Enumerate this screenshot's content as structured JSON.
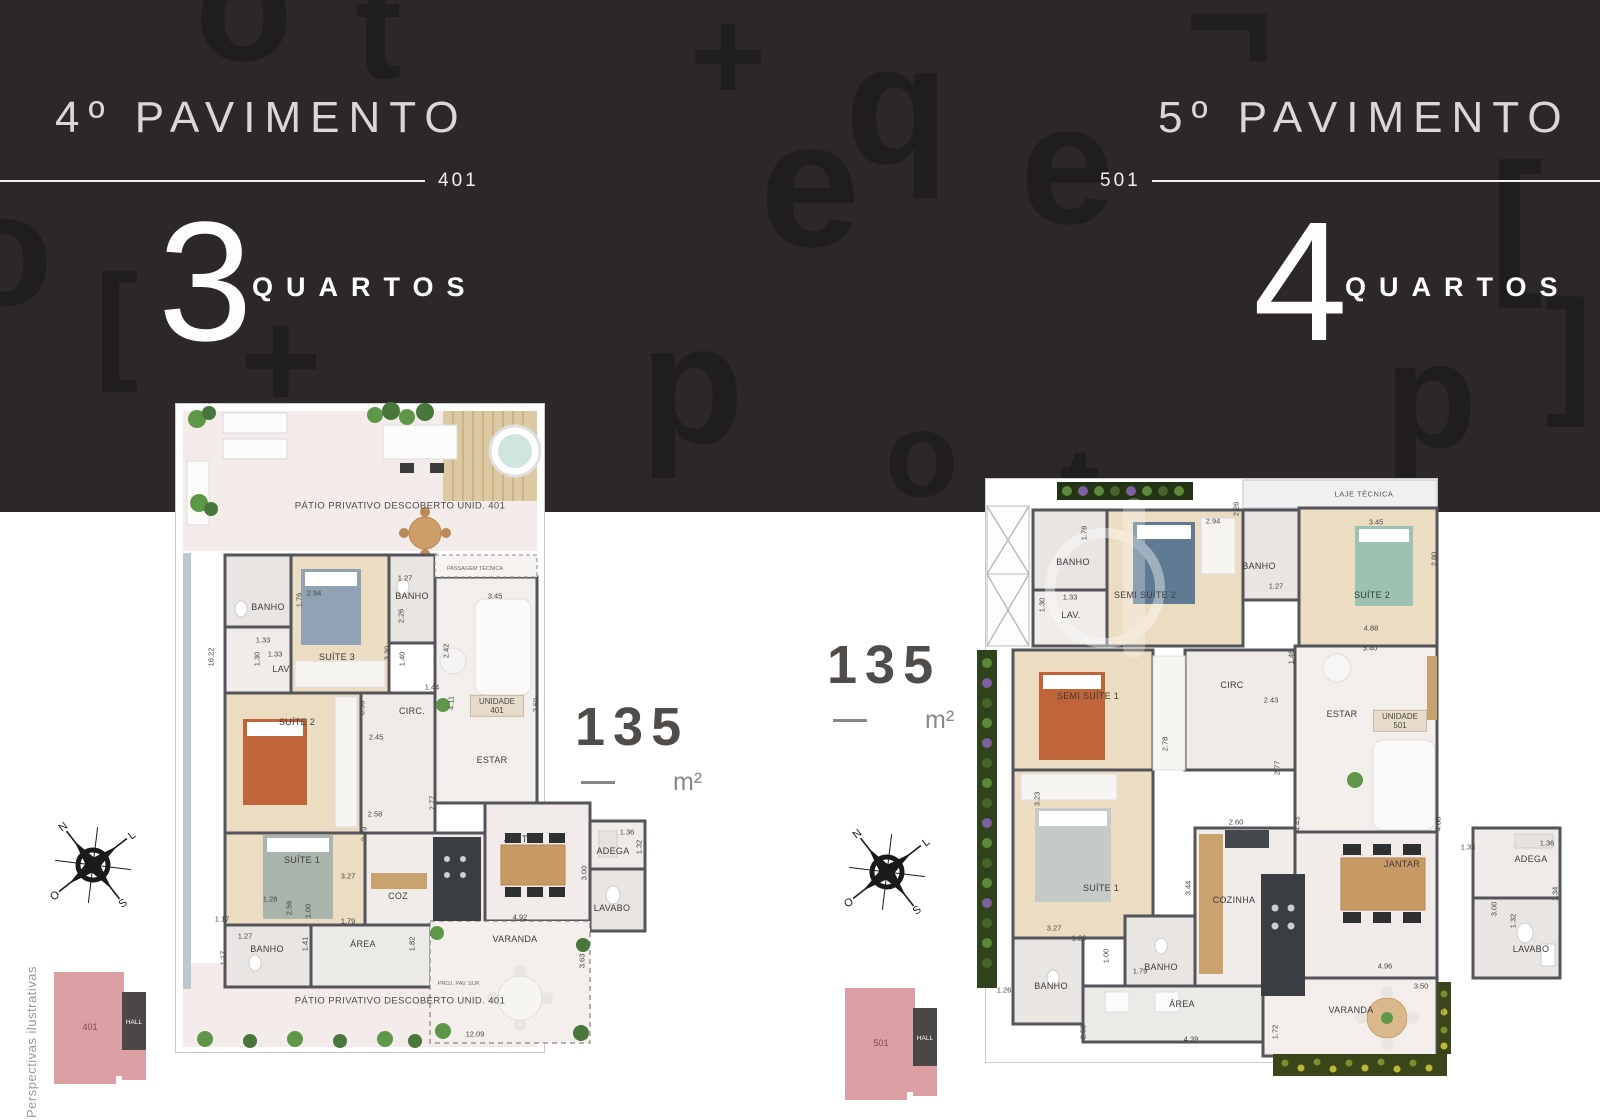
{
  "hero": {
    "bg": "#2b2827",
    "left": {
      "title": "4º PAVIMENTO",
      "unit": "401",
      "count": "3",
      "label": "QUARTOS"
    },
    "right": {
      "title": "5º PAVIMENTO",
      "unit": "501",
      "count": "4",
      "label": "QUARTOS"
    },
    "glyphs": [
      {
        "ch": "o",
        "x": 195,
        "y": -75,
        "s": 160
      },
      {
        "ch": "t",
        "x": 355,
        "y": -40,
        "s": 140
      },
      {
        "ch": "¬",
        "x": 1185,
        "y": -55,
        "s": 150
      },
      {
        "ch": "+",
        "x": 690,
        "y": -10,
        "s": 130
      },
      {
        "ch": "q",
        "x": 845,
        "y": 20,
        "s": 170
      },
      {
        "ch": "e",
        "x": 760,
        "y": 95,
        "s": 180
      },
      {
        "ch": "e",
        "x": 1020,
        "y": 80,
        "s": 170
      },
      {
        "ch": "[",
        "x": 1490,
        "y": 140,
        "s": 160
      },
      {
        "ch": "+",
        "x": 240,
        "y": 290,
        "s": 140
      },
      {
        "ch": "o",
        "x": -45,
        "y": 170,
        "s": 160
      },
      {
        "ch": "[",
        "x": 95,
        "y": 255,
        "s": 130
      },
      {
        "ch": "p",
        "x": 640,
        "y": 300,
        "s": 170
      },
      {
        "ch": "o",
        "x": 885,
        "y": 395,
        "s": 120
      },
      {
        "ch": "p",
        "x": 1385,
        "y": 320,
        "s": 150
      },
      {
        "ch": "]",
        "x": 1545,
        "y": 280,
        "s": 140
      },
      {
        "ch": "t",
        "x": 1060,
        "y": 430,
        "s": 120
      }
    ]
  },
  "area_badges": {
    "left": {
      "value": "135",
      "unit": "m²"
    },
    "right": {
      "value": "135",
      "unit": "m²"
    }
  },
  "compass": {
    "west": "O",
    "north": "N",
    "south": "S",
    "east": "L"
  },
  "keyplans": {
    "left": {
      "unit": "401",
      "hall": "HALL"
    },
    "right": {
      "unit": "501",
      "hall": "HALL"
    }
  },
  "footnote": "Perspectivas ilustrativas",
  "left_plan": {
    "labels": [
      {
        "t": "PÁTIO PRIVATIVO DESCOBERTO UNID. 401",
        "x": 225,
        "y": 103,
        "c": "patio"
      },
      {
        "t": "PASSAGEM TÉCNICA",
        "x": 300,
        "y": 166,
        "c": "tiny"
      },
      {
        "t": "BANHO",
        "x": 93,
        "y": 204,
        "c": "room"
      },
      {
        "t": "SUÍTE 3",
        "x": 162,
        "y": 254,
        "c": "room"
      },
      {
        "t": "LAV.",
        "x": 107,
        "y": 266,
        "c": "room"
      },
      {
        "t": "BANHO",
        "x": 237,
        "y": 193,
        "c": "room"
      },
      {
        "t": "SUÍTE 2",
        "x": 122,
        "y": 319,
        "c": "room"
      },
      {
        "t": "CIRC.",
        "x": 237,
        "y": 308,
        "c": "room"
      },
      {
        "t": "UNIDADE 401",
        "x": 322,
        "y": 303,
        "c": "tag"
      },
      {
        "t": "ESTAR",
        "x": 317,
        "y": 357,
        "c": "room"
      },
      {
        "t": "SUÍTE 1",
        "x": 127,
        "y": 457,
        "c": "room"
      },
      {
        "t": "COZ",
        "x": 223,
        "y": 493,
        "c": "room"
      },
      {
        "t": "BANHO",
        "x": 92,
        "y": 546,
        "c": "room"
      },
      {
        "t": "ÁREA",
        "x": 188,
        "y": 541,
        "c": "room"
      },
      {
        "t": "JANTAR",
        "x": 347,
        "y": 436,
        "c": "room"
      },
      {
        "t": "ADEGA",
        "x": 438,
        "y": 448,
        "c": "room"
      },
      {
        "t": "LAVABO",
        "x": 437,
        "y": 505,
        "c": "room"
      },
      {
        "t": "VARANDA",
        "x": 340,
        "y": 536,
        "c": "room"
      },
      {
        "t": "PROJ. PAV. SUP.",
        "x": 284,
        "y": 581,
        "c": "tiny"
      },
      {
        "t": "PÁTIO PRIVATIVO DESCOBERTO UNID. 401",
        "x": 225,
        "y": 598,
        "c": "patio"
      },
      {
        "t": "16.22",
        "x": 36,
        "y": 254,
        "c": "dim",
        "v": 1
      },
      {
        "t": "1.76",
        "x": 124,
        "y": 197,
        "c": "dim",
        "v": 1
      },
      {
        "t": "2.94",
        "x": 139,
        "y": 190,
        "c": "dim"
      },
      {
        "t": "1.27",
        "x": 230,
        "y": 175,
        "c": "dim"
      },
      {
        "t": "2.26",
        "x": 226,
        "y": 213,
        "c": "dim",
        "v": 1
      },
      {
        "t": "1.33",
        "x": 88,
        "y": 237,
        "c": "dim"
      },
      {
        "t": "1.30",
        "x": 82,
        "y": 256,
        "c": "dim",
        "v": 1
      },
      {
        "t": "1.33",
        "x": 100,
        "y": 251,
        "c": "dim"
      },
      {
        "t": "3.30",
        "x": 212,
        "y": 250,
        "c": "dim",
        "v": 1
      },
      {
        "t": "1.40",
        "x": 227,
        "y": 256,
        "c": "dim",
        "v": 1
      },
      {
        "t": "2.42",
        "x": 271,
        "y": 248,
        "c": "dim",
        "v": 1
      },
      {
        "t": "3.45",
        "x": 320,
        "y": 193,
        "c": "dim"
      },
      {
        "t": "0.96",
        "x": 187,
        "y": 305,
        "c": "dim",
        "v": 1
      },
      {
        "t": "2.45",
        "x": 201,
        "y": 334,
        "c": "dim"
      },
      {
        "t": "1.44",
        "x": 257,
        "y": 284,
        "c": "dim"
      },
      {
        "t": "4.11",
        "x": 276,
        "y": 300,
        "c": "dim",
        "v": 1
      },
      {
        "t": "7.59",
        "x": 361,
        "y": 302,
        "c": "dim",
        "v": 1
      },
      {
        "t": "2.77",
        "x": 257,
        "y": 400,
        "c": "dim",
        "v": 1
      },
      {
        "t": "2.58",
        "x": 200,
        "y": 411,
        "c": "dim"
      },
      {
        "t": "2.29",
        "x": 189,
        "y": 431,
        "c": "dim",
        "v": 1
      },
      {
        "t": "3.27",
        "x": 173,
        "y": 473,
        "c": "dim"
      },
      {
        "t": "1.28",
        "x": 95,
        "y": 496,
        "c": "dim"
      },
      {
        "t": "2.56",
        "x": 114,
        "y": 505,
        "c": "dim",
        "v": 1
      },
      {
        "t": "1.00",
        "x": 133,
        "y": 508,
        "c": "dim",
        "v": 1
      },
      {
        "t": "1.79",
        "x": 173,
        "y": 518,
        "c": "dim"
      },
      {
        "t": "1.17",
        "x": 47,
        "y": 516,
        "c": "dim"
      },
      {
        "t": "1.27",
        "x": 70,
        "y": 533,
        "c": "dim"
      },
      {
        "t": "1.17",
        "x": 48,
        "y": 555,
        "c": "dim",
        "v": 1
      },
      {
        "t": "1.41",
        "x": 130,
        "y": 541,
        "c": "dim",
        "v": 1
      },
      {
        "t": "1.82",
        "x": 237,
        "y": 541,
        "c": "dim",
        "v": 1
      },
      {
        "t": "1.36",
        "x": 452,
        "y": 429,
        "c": "dim"
      },
      {
        "t": "1.32",
        "x": 464,
        "y": 444,
        "c": "dim",
        "v": 1
      },
      {
        "t": "3.00",
        "x": 409,
        "y": 470,
        "c": "dim",
        "v": 1
      },
      {
        "t": "4.92",
        "x": 345,
        "y": 514,
        "c": "dim"
      },
      {
        "t": "3.63",
        "x": 407,
        "y": 558,
        "c": "dim",
        "v": 1
      },
      {
        "t": "12.09",
        "x": 300,
        "y": 631,
        "c": "dim"
      }
    ]
  },
  "right_plan": {
    "labels": [
      {
        "t": "LAJE TÉCNICA",
        "x": 389,
        "y": 16,
        "c": "strip"
      },
      {
        "t": "BANHO",
        "x": 98,
        "y": 84,
        "c": "room"
      },
      {
        "t": "LAV.",
        "x": 96,
        "y": 137,
        "c": "room"
      },
      {
        "t": "SEMI SUÍTE 2",
        "x": 170,
        "y": 117,
        "c": "room"
      },
      {
        "t": "BANHO",
        "x": 284,
        "y": 88,
        "c": "room"
      },
      {
        "t": "SUÍTE 2",
        "x": 397,
        "y": 117,
        "c": "room"
      },
      {
        "t": "SEMI SUÍTE 1",
        "x": 113,
        "y": 218,
        "c": "room"
      },
      {
        "t": "CIRC",
        "x": 257,
        "y": 207,
        "c": "room"
      },
      {
        "t": "ESTAR",
        "x": 367,
        "y": 236,
        "c": "room"
      },
      {
        "t": "UNIDADE 501",
        "x": 425,
        "y": 243,
        "c": "tag"
      },
      {
        "t": "SUÍTE 1",
        "x": 126,
        "y": 410,
        "c": "room"
      },
      {
        "t": "COZINHA",
        "x": 259,
        "y": 422,
        "c": "room"
      },
      {
        "t": "BANHO",
        "x": 186,
        "y": 489,
        "c": "room"
      },
      {
        "t": "BANHO",
        "x": 76,
        "y": 508,
        "c": "room"
      },
      {
        "t": "ÁREA",
        "x": 207,
        "y": 526,
        "c": "room"
      },
      {
        "t": "JANTAR",
        "x": 427,
        "y": 386,
        "c": "room"
      },
      {
        "t": "ADEGA",
        "x": 556,
        "y": 381,
        "c": "room"
      },
      {
        "t": "LAVABO",
        "x": 556,
        "y": 471,
        "c": "room"
      },
      {
        "t": "VARANDA",
        "x": 376,
        "y": 532,
        "c": "room"
      },
      {
        "t": "1.76",
        "x": 109,
        "y": 55,
        "c": "dim",
        "v": 1
      },
      {
        "t": "2.94",
        "x": 238,
        "y": 43,
        "c": "dim"
      },
      {
        "t": "2.26",
        "x": 261,
        "y": 31,
        "c": "dim",
        "v": 1
      },
      {
        "t": "1.27",
        "x": 301,
        "y": 108,
        "c": "dim"
      },
      {
        "t": "3.45",
        "x": 401,
        "y": 44,
        "c": "dim"
      },
      {
        "t": "2.80",
        "x": 459,
        "y": 81,
        "c": "dim",
        "v": 1
      },
      {
        "t": "4.88",
        "x": 396,
        "y": 150,
        "c": "dim"
      },
      {
        "t": "1.30",
        "x": 67,
        "y": 127,
        "c": "dim",
        "v": 1
      },
      {
        "t": "1.33",
        "x": 95,
        "y": 119,
        "c": "dim"
      },
      {
        "t": "3.40",
        "x": 395,
        "y": 170,
        "c": "dim"
      },
      {
        "t": "1.46",
        "x": 316,
        "y": 179,
        "c": "dim",
        "v": 1
      },
      {
        "t": "2.43",
        "x": 296,
        "y": 222,
        "c": "dim"
      },
      {
        "t": "2.78",
        "x": 190,
        "y": 266,
        "c": "dim",
        "v": 1
      },
      {
        "t": "2.77",
        "x": 302,
        "y": 290,
        "c": "dim",
        "v": 1
      },
      {
        "t": "3.23",
        "x": 62,
        "y": 321,
        "c": "dim",
        "v": 1
      },
      {
        "t": "2.60",
        "x": 261,
        "y": 344,
        "c": "dim"
      },
      {
        "t": "2.58",
        "x": 261,
        "y": 362,
        "c": "dim"
      },
      {
        "t": "4.43",
        "x": 322,
        "y": 346,
        "c": "dim",
        "v": 1
      },
      {
        "t": "4.88",
        "x": 463,
        "y": 346,
        "c": "dim",
        "v": 1
      },
      {
        "t": "3.27",
        "x": 79,
        "y": 450,
        "c": "dim"
      },
      {
        "t": "1.26",
        "x": 104,
        "y": 460,
        "c": "dim"
      },
      {
        "t": "1.00",
        "x": 131,
        "y": 478,
        "c": "dim",
        "v": 1
      },
      {
        "t": "1.79",
        "x": 165,
        "y": 493,
        "c": "dim"
      },
      {
        "t": "3.44",
        "x": 213,
        "y": 410,
        "c": "dim",
        "v": 1
      },
      {
        "t": "1.26",
        "x": 29,
        "y": 512,
        "c": "dim"
      },
      {
        "t": "2.58",
        "x": 108,
        "y": 554,
        "c": "dim",
        "v": 1
      },
      {
        "t": "4.39",
        "x": 216,
        "y": 561,
        "c": "dim"
      },
      {
        "t": "1.72",
        "x": 300,
        "y": 554,
        "c": "dim",
        "v": 1
      },
      {
        "t": "1.33",
        "x": 493,
        "y": 369,
        "c": "dim"
      },
      {
        "t": "1.36",
        "x": 572,
        "y": 365,
        "c": "dim"
      },
      {
        "t": "1.34",
        "x": 580,
        "y": 416,
        "c": "dim",
        "v": 1
      },
      {
        "t": "3.00",
        "x": 519,
        "y": 431,
        "c": "dim",
        "v": 1
      },
      {
        "t": "1.32",
        "x": 538,
        "y": 443,
        "c": "dim",
        "v": 1
      },
      {
        "t": "4.96",
        "x": 410,
        "y": 488,
        "c": "dim"
      },
      {
        "t": "3.50",
        "x": 446,
        "y": 508,
        "c": "dim"
      },
      {
        "t": "1.53",
        "x": 466,
        "y": 534,
        "c": "dim",
        "v": 1
      }
    ]
  }
}
